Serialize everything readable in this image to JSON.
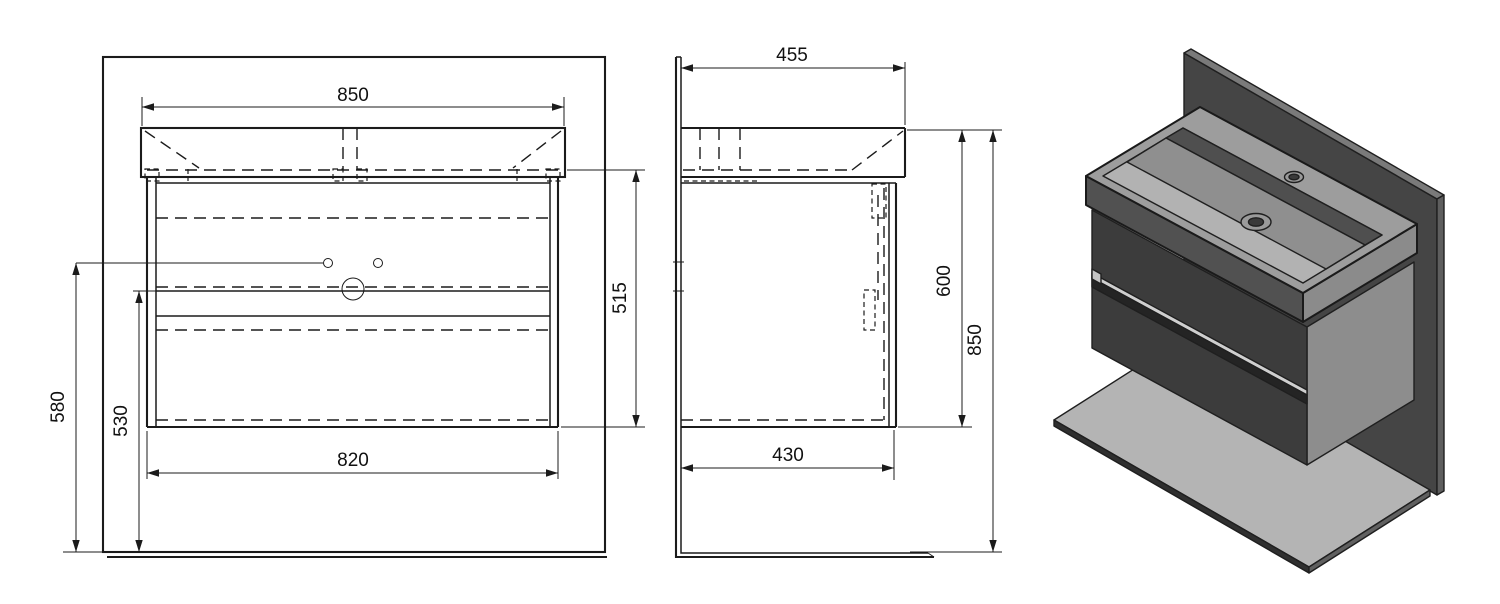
{
  "dimensions": {
    "front_view": {
      "width_top": "850",
      "height_right": "515",
      "height_left_outer": "580",
      "height_left_inner": "530",
      "width_bottom": "820"
    },
    "side_view": {
      "depth_top": "455",
      "height_cabinet": "600",
      "height_total": "850",
      "depth_bottom": "430"
    }
  },
  "colors": {
    "line": "#1b1b1b",
    "background": "#ffffff",
    "iso": {
      "wall": "#454545",
      "wall_edge_top": "#7a7a7a",
      "wall_edge_right": "#5e5e5e",
      "floor": "#b4b4b4",
      "floor_edge_front": "#2f2f2f",
      "floor_edge_right": "#606060",
      "cabinet_front": "#3c3c3c",
      "cabinet_side": "#8d8d8d",
      "drawer_strip_light": "#cfcfcf",
      "drawer_strip_dark": "#242424",
      "handle_notch": "#c4c4c4",
      "basin_deck": "#9d9d9d",
      "basin_face_front": "#515151",
      "basin_face_right": "#8b8b8b",
      "basin_interior": "#b2b2b2",
      "basin_back_wall": "#4f4f4f",
      "basin_floor": "#8f8f8f",
      "hole_ring": "#9a9a9a",
      "hole_dark": "#3a3a3a"
    }
  }
}
